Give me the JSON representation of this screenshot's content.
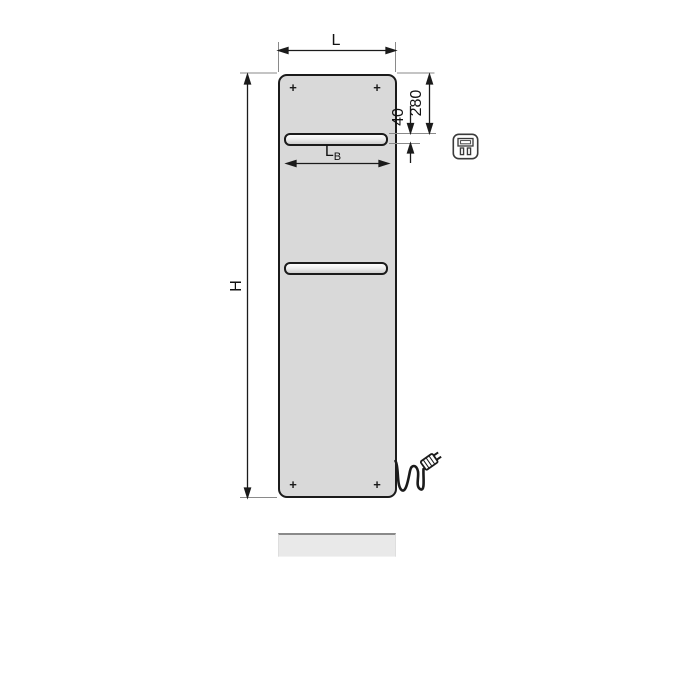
{
  "page": {
    "background": "#ffffff",
    "description": "Technical dimension drawing of a flat electric panel radiator, front view"
  },
  "diagram": {
    "dimensions": {
      "width_label": "L",
      "height_label": "H",
      "bar_width_label_main": "L",
      "bar_width_label_sub": "B",
      "top_to_slot": "280",
      "slot_height": "40"
    },
    "markers": {
      "mounting_mark": "+"
    },
    "icons": [
      "electric-plug-badge-icon"
    ],
    "colors": {
      "panel_fill": "#d9d9d9",
      "outline": "#1b1b1b",
      "extension_line": "#8a8a8a",
      "floor_strip": "#e9e9e9"
    }
  }
}
